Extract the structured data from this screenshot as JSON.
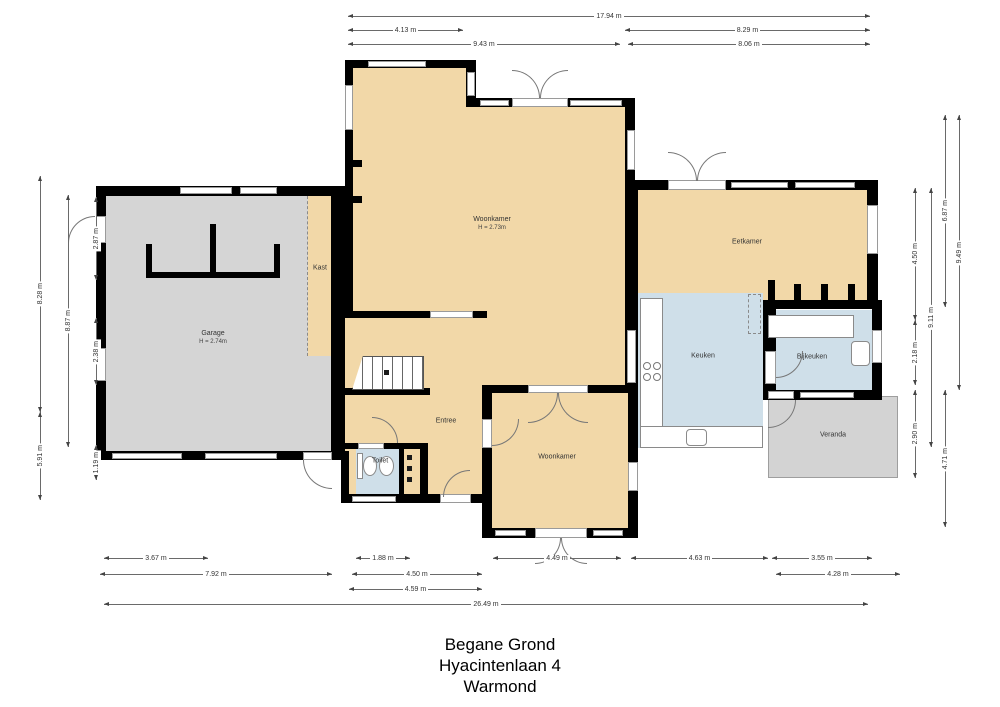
{
  "title": {
    "line1": "Begane Grond",
    "line2": "Hyacintenlaan 4",
    "line3": "Warmond"
  },
  "rooms": [
    {
      "id": "woonkamer-main",
      "label": "Woonkamer",
      "note": "H = 2.73m"
    },
    {
      "id": "garage",
      "label": "Garage",
      "note": "H = 2.74m"
    },
    {
      "id": "kast",
      "label": "Kast"
    },
    {
      "id": "entree",
      "label": "Entree"
    },
    {
      "id": "toilet",
      "label": "Toilet"
    },
    {
      "id": "woonkamer-2",
      "label": "Woonkamer"
    },
    {
      "id": "keuken",
      "label": "Keuken"
    },
    {
      "id": "bijkeuken",
      "label": "Bijkeuken"
    },
    {
      "id": "eetkamer",
      "label": "Eetkamer"
    },
    {
      "id": "veranda",
      "label": "Veranda"
    }
  ],
  "dimensions": {
    "top": [
      {
        "label": "17.94 m",
        "x": 348,
        "y": 12,
        "len": 522
      },
      {
        "label": "4.13 m",
        "x": 348,
        "y": 26,
        "len": 115
      },
      {
        "label": "8.29 m",
        "x": 625,
        "y": 26,
        "len": 245
      },
      {
        "label": "9.43 m",
        "x": 348,
        "y": 40,
        "len": 272
      },
      {
        "label": "8.06 m",
        "x": 628,
        "y": 40,
        "len": 242
      }
    ],
    "bottom": [
      {
        "label": "3.67 m",
        "x": 104,
        "y": 554,
        "len": 104
      },
      {
        "label": "1.88 m",
        "x": 356,
        "y": 554,
        "len": 54
      },
      {
        "label": "4.49 m",
        "x": 493,
        "y": 554,
        "len": 128
      },
      {
        "label": "4.63 m",
        "x": 631,
        "y": 554,
        "len": 137
      },
      {
        "label": "3.55 m",
        "x": 772,
        "y": 554,
        "len": 100
      },
      {
        "label": "7.92 m",
        "x": 100,
        "y": 570,
        "len": 232
      },
      {
        "label": "4.50 m",
        "x": 352,
        "y": 570,
        "len": 130
      },
      {
        "label": "4.28 m",
        "x": 776,
        "y": 570,
        "len": 124
      },
      {
        "label": "4.59 m",
        "x": 349,
        "y": 585,
        "len": 133
      },
      {
        "label": "26.49 m",
        "x": 104,
        "y": 600,
        "len": 764
      }
    ],
    "left": [
      {
        "label": "8.28 m",
        "x": 36,
        "y": 176,
        "len": 236
      },
      {
        "label": "5.91 m",
        "x": 36,
        "y": 412,
        "len": 88
      },
      {
        "label": "8.87 m",
        "x": 64,
        "y": 195,
        "len": 252
      },
      {
        "label": "2.87 m",
        "x": 92,
        "y": 197,
        "len": 83
      },
      {
        "label": "2.38 m",
        "x": 92,
        "y": 318,
        "len": 67
      },
      {
        "label": "1.19 m",
        "x": 92,
        "y": 445,
        "len": 35
      }
    ],
    "right": [
      {
        "label": "4.50 m",
        "x": 911,
        "y": 188,
        "len": 132
      },
      {
        "label": "2.18 m",
        "x": 911,
        "y": 320,
        "len": 65
      },
      {
        "label": "2.90 m",
        "x": 911,
        "y": 390,
        "len": 88
      },
      {
        "label": "9.11 m",
        "x": 927,
        "y": 188,
        "len": 259
      },
      {
        "label": "6.87 m",
        "x": 941,
        "y": 115,
        "len": 192
      },
      {
        "label": "4.71 m",
        "x": 941,
        "y": 390,
        "len": 137
      },
      {
        "label": "9.49 m",
        "x": 955,
        "y": 115,
        "len": 275
      }
    ]
  },
  "colors": {
    "room_tan": "#f2d8a8",
    "wet_room_blue": "#cfdfe9",
    "garage_gray": "#d5d5d5",
    "veranda_gray": "#d3d3d3",
    "wall_black": "#000000"
  }
}
